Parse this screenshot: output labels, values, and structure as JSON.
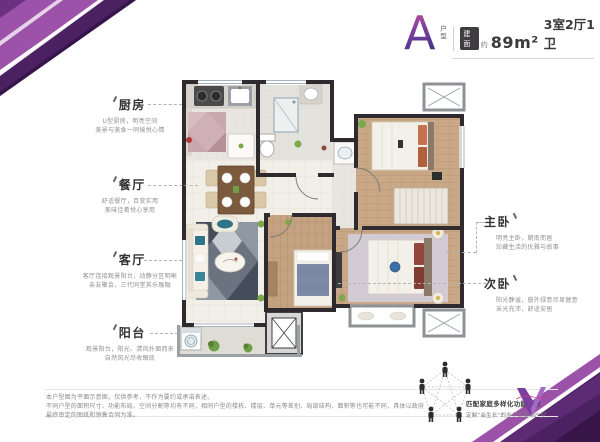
{
  "title": {
    "letter": "A",
    "letter_tag": "户型",
    "area_tag": "建面",
    "approx": "约",
    "area_value": "89m²",
    "layout": "3室2厅1卫"
  },
  "rooms": {
    "kitchen": {
      "name": "厨房",
      "line1": "U型厨房，明亮空间",
      "line2": "美景与美食一同愉悦心情"
    },
    "dining": {
      "name": "餐厅",
      "line1": "舒适餐厅，百变实用",
      "line2": "美味佳肴悦心享用"
    },
    "living": {
      "name": "客厅",
      "line1": "客厅连接观景阳台，动静分区明晰",
      "line2": "亲友聚会，三代同堂其乐融融"
    },
    "balcony": {
      "name": "阳台",
      "line1": "观景阳台，阳光、清风扑面而来",
      "line2": "自然风光尽收眼底"
    },
    "master": {
      "name": "主卧",
      "line1": "明亮主卧，朝南而居",
      "line2": "珍藏生活的优雅与故事"
    },
    "second": {
      "name": "次卧",
      "line1": "阳光静谧，窗外绿意尽显惬意",
      "line2": "采光充沛，舒适安居"
    }
  },
  "footer": {
    "disclaimer1": "本户型图为平面示意图，仅供参考，不作为要约或承诺表述。",
    "disclaimer2": "不同户型的面积尺寸、功能布局、空间分割等均有不同，相同户型的楼栋、楼层、单元等差别、局部结构、面积等也可能不同，具体以政府最终审定的图纸和销售合同为准。"
  },
  "promo": {
    "caption1": "匹配家庭多样化功能需求",
    "caption2": "定制“会生长”的全生命周期户型"
  },
  "colors": {
    "accent_purple": "#7b3fa0",
    "ribbon_dark": "#4b2162",
    "wall": "#2e2a2d",
    "wood_floor": "#c9a887",
    "living_rug": "#5a6270",
    "teal_pillow": "#2f7486"
  }
}
